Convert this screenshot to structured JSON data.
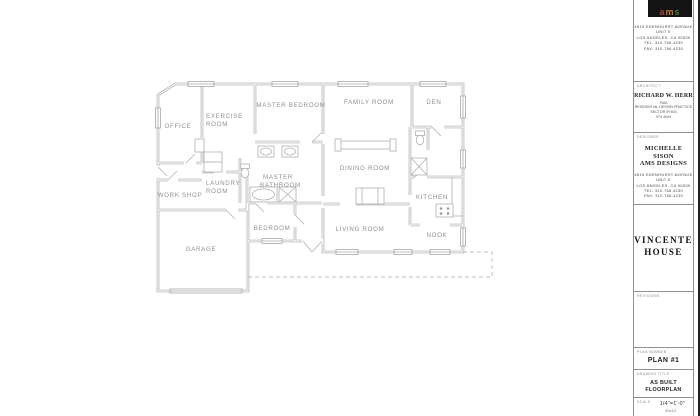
{
  "plan": {
    "wall_color": "#a6a6a6",
    "fixture_color": "#b0b0b0",
    "label_color": "#8f8f8f",
    "dash_color": "#bdbdbd",
    "rooms": [
      {
        "id": "office",
        "label": "OFFICE"
      },
      {
        "id": "exercise-room",
        "label": "EXERCISE",
        "label2": "ROOM"
      },
      {
        "id": "master-bedroom",
        "label": "MASTER BEDROOM"
      },
      {
        "id": "family-room",
        "label": "FAMILY ROOM"
      },
      {
        "id": "den",
        "label": "DEN"
      },
      {
        "id": "master-bathroom",
        "label": "MASTER",
        "label2": "BATHROOM"
      },
      {
        "id": "dining-room",
        "label": "DINING ROOM"
      },
      {
        "id": "laundry-room",
        "label": "LAUNDRY",
        "label2": "ROOM"
      },
      {
        "id": "work-shop",
        "label": "WORK SHOP"
      },
      {
        "id": "kitchen",
        "label": "KITCHEN"
      },
      {
        "id": "garage",
        "label": "GARAGE"
      },
      {
        "id": "bedroom",
        "label": "BEDROOM"
      },
      {
        "id": "living-room",
        "label": "LIVING ROOM"
      },
      {
        "id": "nook",
        "label": "NOOK"
      }
    ]
  },
  "titleblock": {
    "logo": {
      "text": "ams",
      "letters": [
        "a",
        "m",
        "s"
      ],
      "letter_colors": [
        "#a94438",
        "#c07a30",
        "#4f7a3a"
      ],
      "background": "#141414"
    },
    "firm_address": [
      "4619 EDENHURST AVENUE",
      "UNIT E",
      "LOS ANGELES, CA 90039",
      "TEL: 310.766.4230",
      "FAX: 310.766.4230"
    ],
    "architect": {
      "section_label": "ARCHITECT",
      "name": "RICHARD W. HERR",
      "details": [
        "FAIA",
        "RESIDENTIAL DESIGN PRACTICE",
        "SECTOR IP/403",
        "973 4044"
      ]
    },
    "designer": {
      "section_label": "DESIGNER",
      "name_line1": "MICHELLE SISON",
      "name_line2": "AMS DESIGNS"
    },
    "project": {
      "name_line1": "VINCENTE",
      "name_line2": "HOUSE"
    },
    "revisions": {
      "section_label": "REVISIONS"
    },
    "plan_number": {
      "section_label": "PLAN NUMBER",
      "value": "PLAN #1"
    },
    "drawing_title": {
      "section_label": "DRAWING TITLE",
      "line1": "AS BUILT",
      "line2": "FLOORPLAN"
    },
    "scale": {
      "section_label": "SCALE",
      "value": "1/4\"=1'-0\"",
      "note": "20x13"
    }
  }
}
